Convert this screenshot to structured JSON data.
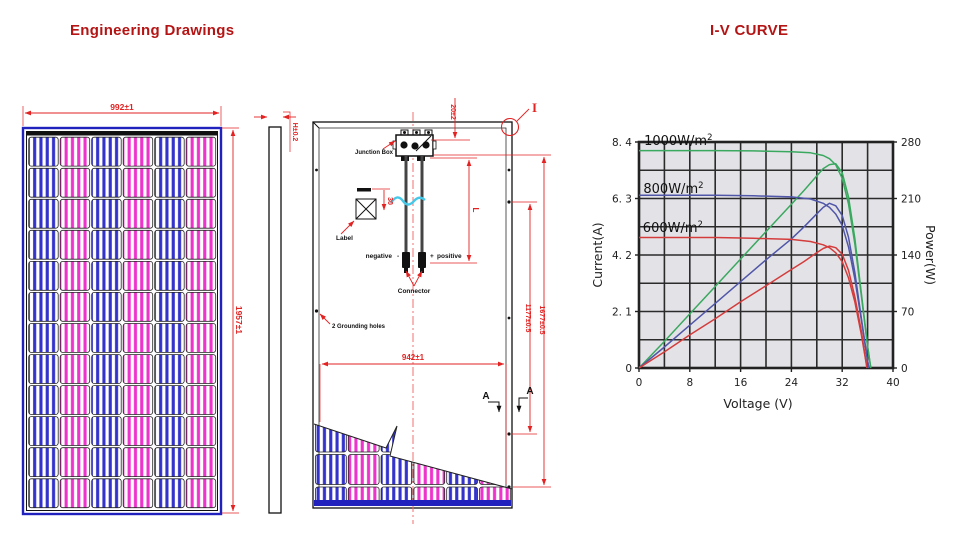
{
  "headers": {
    "left_title": "Engineering Drawings",
    "right_title": "I-V CURVE",
    "color": "#b41414"
  },
  "drawings": {
    "front_view": {
      "width_dim": "992±1",
      "height_dim": "1957±1"
    },
    "side_view": {
      "thickness_dim": "H±0.2"
    },
    "back_view": {
      "junction_box_label": "Junction Box",
      "top_offset_dim": "20±2",
      "detail_marker": "I",
      "label_text": "Label",
      "label_offset_dim": "30",
      "cable_length_dim": "L",
      "negative_label": "negative",
      "minus_sign": "-",
      "plus_sign": "+",
      "positive_label": "positive",
      "connector_label": "Connector",
      "grounding_label": "2 Grounding holes",
      "inner_height_dim": "1177±0.5",
      "outer_height_dim": "1677±0.5",
      "bottom_width_dim": "942±1",
      "section_marker": "A"
    },
    "colors": {
      "dimension_red": "#e32222",
      "frame_blue": "#2121bd",
      "cell_blue": "#3333cc",
      "cell_magenta": "#ee33cc",
      "line_black": "#1a1a1a",
      "break_wave_cyan": "#45c8e8"
    }
  },
  "chart_data": {
    "type": "line",
    "title": "I-V CURVE",
    "xlabel": "Voltage (V)",
    "ylabel_left": "Current(A)",
    "ylabel_right": "Power(W)",
    "xlim": [
      0,
      40
    ],
    "ylim_left": [
      0,
      8.4
    ],
    "ylim_right": [
      0,
      280
    ],
    "x_grid_step": 4,
    "y_grid_step": 1.05,
    "grid": true,
    "plot_bg": "#e3e3e7",
    "grid_color": "#2b2b2b",
    "x_ticks": [
      {
        "v": 0,
        "label": "0"
      },
      {
        "v": 8,
        "label": "8"
      },
      {
        "v": 16,
        "label": "16"
      },
      {
        "v": 24,
        "label": "24"
      },
      {
        "v": 32,
        "label": "32"
      },
      {
        "v": 40,
        "label": "40"
      }
    ],
    "left_ticks": [
      {
        "v": 8.4,
        "label": "8. 4"
      },
      {
        "v": 6.3,
        "label": "6. 3"
      },
      {
        "v": 4.2,
        "label": "4. 2"
      },
      {
        "v": 2.1,
        "label": "2. 1"
      },
      {
        "v": 0,
        "label": "0"
      }
    ],
    "right_ticks": [
      {
        "v": 280,
        "label": "280"
      },
      {
        "v": 210,
        "label": "210"
      },
      {
        "v": 140,
        "label": "140"
      },
      {
        "v": 70,
        "label": "70"
      },
      {
        "v": 0,
        "label": "0"
      }
    ],
    "curve_labels": [
      {
        "text": "1000W/m",
        "sup": "2",
        "x": 0.8,
        "y": 8.44
      },
      {
        "text": "800W/m",
        "sup": "2",
        "x": 0.7,
        "y": 6.65
      },
      {
        "text": "600W/m",
        "sup": "2",
        "x": 0.6,
        "y": 5.2
      }
    ],
    "series": [
      {
        "name": "1000W/m2-IV",
        "axis": "left",
        "color": "#3aa85f",
        "points": [
          [
            0,
            8.08
          ],
          [
            6,
            8.08
          ],
          [
            12,
            8.08
          ],
          [
            18,
            8.07
          ],
          [
            24,
            8.04
          ],
          [
            27,
            8.0
          ],
          [
            29,
            7.9
          ],
          [
            30,
            7.78
          ],
          [
            31,
            7.55
          ],
          [
            32,
            7.05
          ],
          [
            33,
            6.1
          ],
          [
            34,
            4.6
          ],
          [
            35,
            2.7
          ],
          [
            36,
            0.8
          ],
          [
            36.5,
            0
          ]
        ]
      },
      {
        "name": "1000W/m2-PV",
        "axis": "right",
        "color": "#3aa85f",
        "points": [
          [
            0,
            0
          ],
          [
            4,
            33
          ],
          [
            8,
            67
          ],
          [
            12,
            101
          ],
          [
            16,
            135
          ],
          [
            20,
            169
          ],
          [
            24,
            203
          ],
          [
            26,
            220
          ],
          [
            28,
            238
          ],
          [
            29,
            247
          ],
          [
            30,
            252
          ],
          [
            31,
            253
          ],
          [
            32,
            242
          ],
          [
            33,
            212
          ],
          [
            34,
            160
          ],
          [
            35,
            93
          ],
          [
            36,
            27
          ],
          [
            36.5,
            0
          ]
        ]
      },
      {
        "name": "800W/m2-IV",
        "axis": "left",
        "color": "#5056a8",
        "points": [
          [
            0,
            6.42
          ],
          [
            6,
            6.42
          ],
          [
            12,
            6.42
          ],
          [
            18,
            6.4
          ],
          [
            24,
            6.36
          ],
          [
            27,
            6.28
          ],
          [
            29,
            6.12
          ],
          [
            30,
            5.97
          ],
          [
            31,
            5.72
          ],
          [
            32,
            5.3
          ],
          [
            33,
            4.5
          ],
          [
            34,
            3.3
          ],
          [
            35,
            1.8
          ],
          [
            36,
            0.25
          ],
          [
            36.2,
            0
          ]
        ]
      },
      {
        "name": "800W/m2-PV",
        "axis": "right",
        "color": "#5056a8",
        "points": [
          [
            0,
            0
          ],
          [
            4,
            26
          ],
          [
            8,
            53
          ],
          [
            12,
            80
          ],
          [
            16,
            107
          ],
          [
            20,
            134
          ],
          [
            24,
            160
          ],
          [
            26,
            175
          ],
          [
            28,
            191
          ],
          [
            29,
            199
          ],
          [
            30,
            204
          ],
          [
            31,
            201
          ],
          [
            32,
            189
          ],
          [
            33,
            162
          ],
          [
            34,
            118
          ],
          [
            35,
            62
          ],
          [
            36,
            9
          ],
          [
            36.2,
            0
          ]
        ]
      },
      {
        "name": "600W/m2-IV",
        "axis": "left",
        "color": "#d43c3c",
        "points": [
          [
            0,
            4.85
          ],
          [
            6,
            4.85
          ],
          [
            12,
            4.85
          ],
          [
            18,
            4.82
          ],
          [
            24,
            4.78
          ],
          [
            27,
            4.7
          ],
          [
            29,
            4.58
          ],
          [
            30,
            4.47
          ],
          [
            31,
            4.28
          ],
          [
            32,
            3.95
          ],
          [
            33,
            3.35
          ],
          [
            34,
            2.45
          ],
          [
            35,
            1.25
          ],
          [
            35.9,
            0
          ]
        ]
      },
      {
        "name": "600W/m2-PV",
        "axis": "right",
        "color": "#d43c3c",
        "points": [
          [
            0,
            0
          ],
          [
            4,
            20
          ],
          [
            8,
            41
          ],
          [
            12,
            61
          ],
          [
            16,
            82
          ],
          [
            20,
            102
          ],
          [
            24,
            122
          ],
          [
            26,
            132
          ],
          [
            28,
            143
          ],
          [
            29,
            148
          ],
          [
            30,
            151
          ],
          [
            31,
            149
          ],
          [
            32,
            141
          ],
          [
            33,
            121
          ],
          [
            34,
            88
          ],
          [
            35,
            46
          ],
          [
            35.9,
            0
          ]
        ]
      }
    ]
  }
}
